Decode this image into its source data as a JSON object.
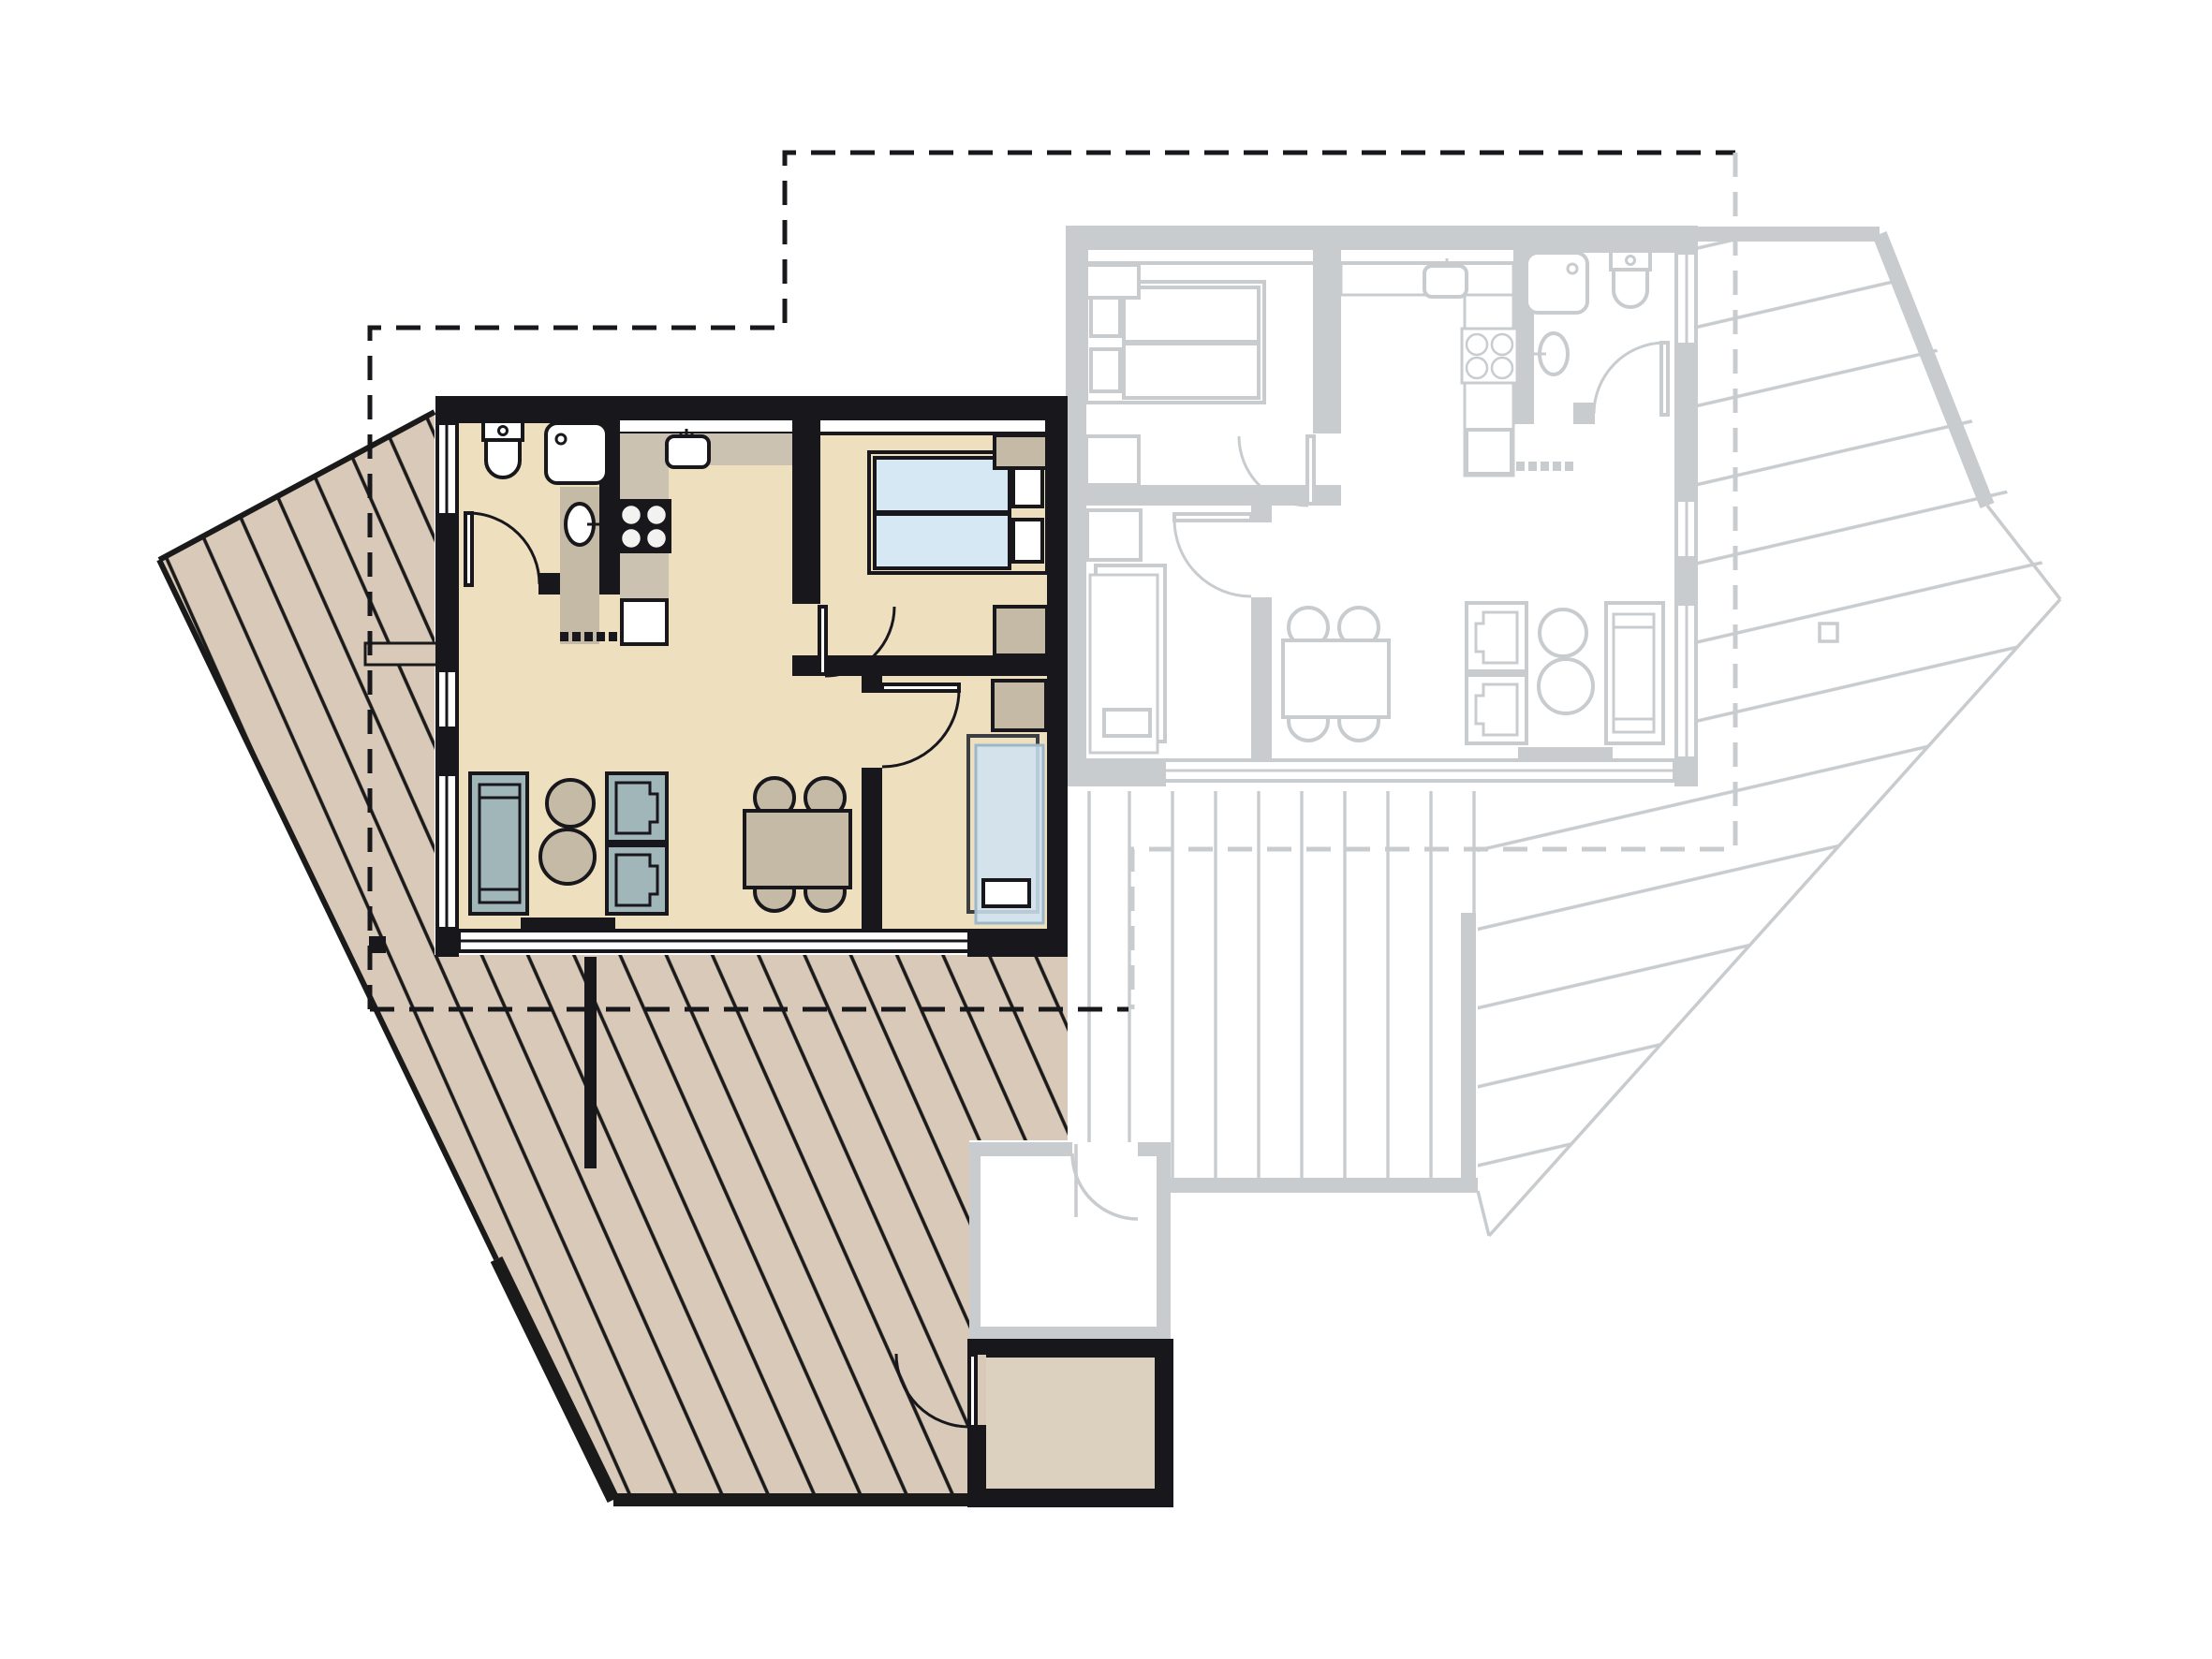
{
  "document": {
    "type": "architectural floor plan",
    "view": "top-down plan",
    "text_labels": [],
    "legend_note": "highlighted apartment shown in color; identical mirrored neighbour unit shown grayed out"
  },
  "highlighted_unit": {
    "name": "highlighted-apartment",
    "rooms": [
      {
        "name": "bathroom",
        "fixtures": [
          "toilet",
          "shower-tray",
          "washbasin-on-vanity",
          "door"
        ]
      },
      {
        "name": "kitchen",
        "fixtures": [
          "kitchen-sink",
          "cooktop-4-burners",
          "counter-l-shape",
          "built-in-appliance",
          "sliding-partition-dashes"
        ]
      },
      {
        "name": "bedroom",
        "fixtures": [
          "double-bed-2-mattresses",
          "pillow",
          "pillow",
          "nightstand",
          "nightstand",
          "door"
        ]
      },
      {
        "name": "living-dining-room",
        "fixtures": [
          "sofa",
          "armchair",
          "armchair",
          "coffee-table-round-small",
          "coffee-table-round-large",
          "tv-bench",
          "dining-table",
          "stool",
          "stool",
          "stool",
          "stool"
        ]
      },
      {
        "name": "sleeping-nook",
        "fixtures": [
          "daybed",
          "pillow",
          "nightstand",
          "door"
        ]
      },
      {
        "name": "storage-shed",
        "fixtures": [
          "door-to-deck"
        ]
      }
    ],
    "outdoor": {
      "deck": "large wooden deck with diagonal plank hatching wrapping left and bottom sides",
      "privacy_screen": "short black screen wall below living room",
      "roof_outline": "black dashed overhang outline"
    },
    "window_bands": [
      "top wall band",
      "left wall bands",
      "full-width glazing to deck at bottom"
    ]
  },
  "adjacent_unit": {
    "name": "adjacent-apartment-grayed",
    "style": "mirrored duplicate of highlighted unit drawn in light gray outlines",
    "rooms": [
      "bedroom",
      "kitchen",
      "bathroom",
      "living-dining-room",
      "sleeping-nook",
      "storage-room"
    ],
    "outdoor": {
      "terrace_vertical_planks": "terrace with vertical plank lines below unit",
      "deck_diagonal": "angled deck with near-horizontal plank lines on right side",
      "roof_outline": "gray dashed overhang outline"
    }
  },
  "colors": {
    "wall": "#17171c",
    "floor": "#eedfbf",
    "deck": "#d8c9b8",
    "deckline": "#1a1a1a",
    "counter": "#cbc2b2",
    "tan": "#c5baa5",
    "teal": "#a0b6b8",
    "blue": "#d5e8f4",
    "dayblue": "#cfe4f2",
    "grayline": "#c8cccf",
    "storage": "#dcd0bf",
    "white": "#ffffff"
  },
  "icons": [
    "toilet-icon",
    "shower-icon",
    "washbasin-icon",
    "sink-icon",
    "cooktop-icon",
    "bed-icon",
    "sofa-icon",
    "armchair-icon",
    "table-icon",
    "door-arc-icon"
  ]
}
